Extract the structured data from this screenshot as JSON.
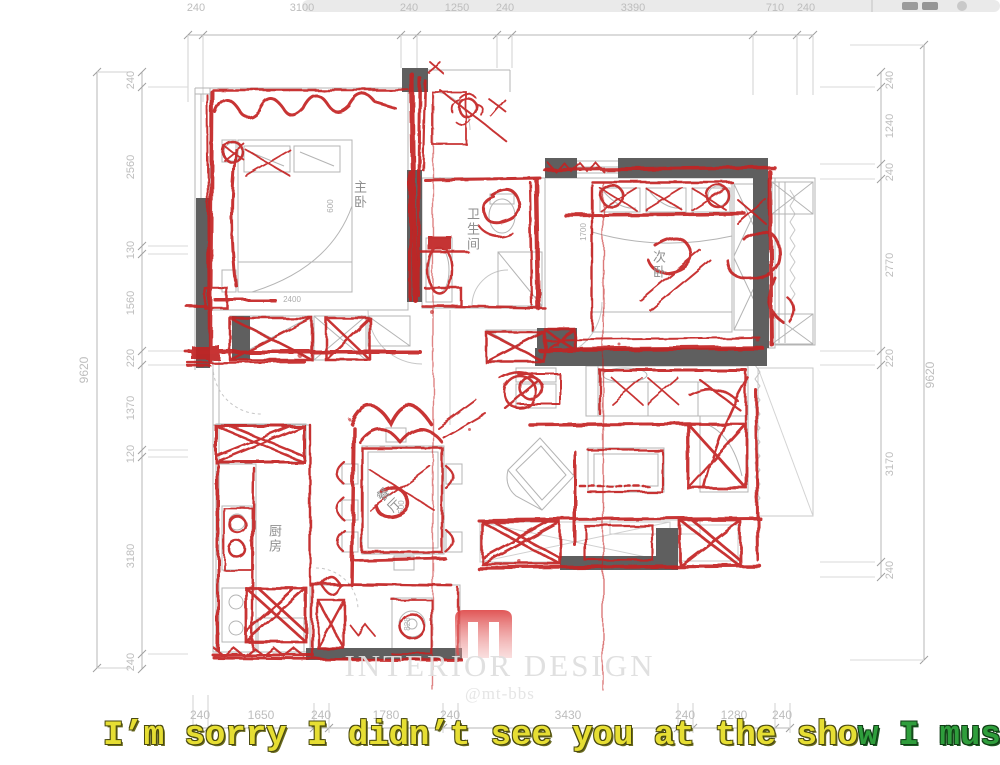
{
  "dimensions": {
    "top": [
      "240",
      "3100",
      "240",
      "1250",
      "240",
      "3390",
      "710",
      "240"
    ],
    "bottom": [
      "240",
      "1650",
      "240",
      "1780",
      "240",
      "3430",
      "240",
      "1280",
      "240"
    ],
    "left_outer": "9620",
    "left_inner": [
      "240",
      "2560",
      "130",
      "1560",
      "220",
      "1370",
      "120",
      "3180",
      "240"
    ],
    "right_outer": "9620",
    "right_inner": [
      "240",
      "1240",
      "240",
      "2770",
      "220",
      "3170",
      "240"
    ]
  },
  "rooms": {
    "master_bedroom": "主卧",
    "bathroom": "卫生间",
    "second_bedroom": "次卧",
    "kitchen": "厨房",
    "dining": "餐厅"
  },
  "internal_dims": {
    "master_bed_width": "2400",
    "master_closet": "600",
    "second_bed_length": "1700",
    "dining_table": "500",
    "balcony_item": "828"
  },
  "watermark": {
    "title": "INTERIOR DESIGN",
    "handle": "@mt-bbs"
  },
  "subtitle": {
    "sung": "I’m sorry I didn’t see you at the sho",
    "upcoming": "w I musta"
  },
  "colors": {
    "red_marker": "#c32121",
    "wall_fill": "#5f5f5f",
    "cad_line": "#b4b4b4",
    "dim_text": "#bdbdbd",
    "subtitle_yellow": "#e6de33",
    "subtitle_green": "#2f9e3c",
    "watermark_red": "#dd4343"
  }
}
